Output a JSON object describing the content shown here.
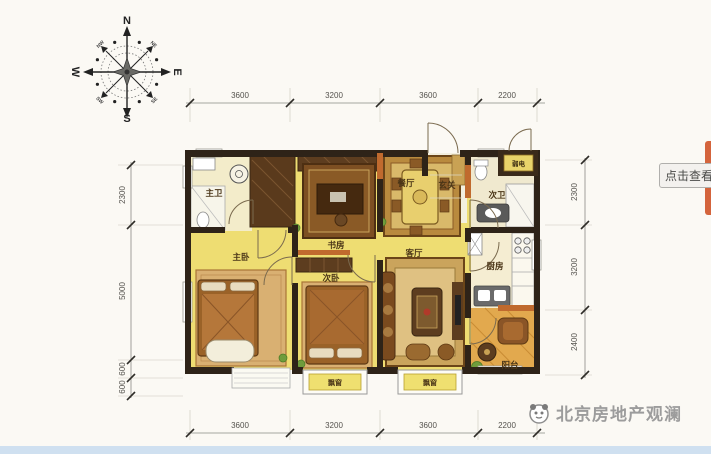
{
  "compass": {
    "north": "N",
    "south": "S",
    "west": "W",
    "east": "E",
    "ne": "NE",
    "se": "SE",
    "sw": "SW",
    "nw": "NW"
  },
  "dimensions": {
    "top": [
      "3600",
      "3200",
      "3600",
      "2200"
    ],
    "bottom": [
      "3600",
      "3200",
      "3600",
      "2200"
    ],
    "left": [
      "2300",
      "5000",
      "600",
      "600"
    ],
    "right": [
      "2300",
      "3200",
      "2400"
    ]
  },
  "rooms": {
    "master_bath": "主卫",
    "study": "书房",
    "dining": "餐厅",
    "entry": "玄关",
    "weak_current": "弱电",
    "second_bath": "次卫",
    "master_bedroom": "主卧",
    "second_bedroom": "次卧",
    "living_room": "客厅",
    "kitchen": "厨房",
    "balcony": "阳台",
    "bay_window": "飘窗"
  },
  "overlay": {
    "view_button": "点击查看"
  },
  "watermark": {
    "text": "北京房地产观澜"
  },
  "colors": {
    "room_yellow": "#eedd72",
    "wall_dark": "#2e2318",
    "accent_orange": "#c06a2e",
    "balcony_orange": "#e2a94e",
    "strip_blue": "#cfe0f0"
  }
}
